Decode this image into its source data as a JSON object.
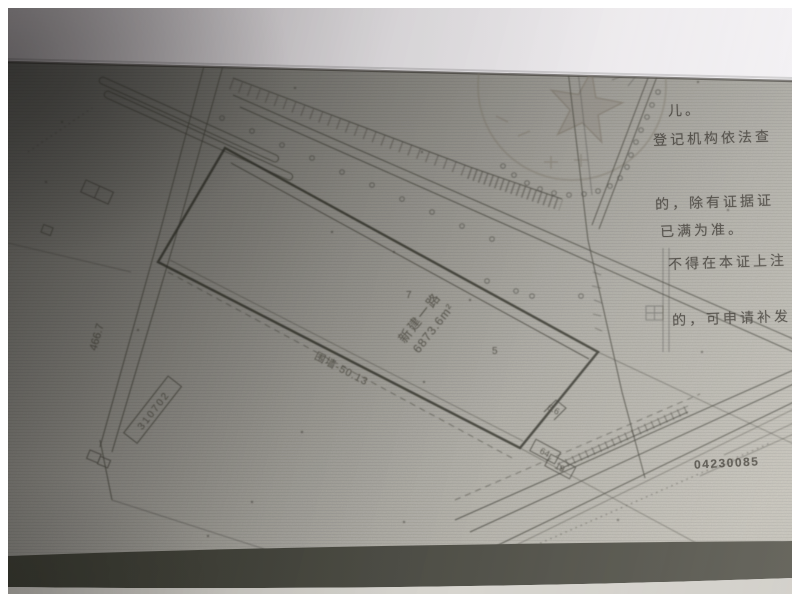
{
  "certificate": {
    "fragments": [
      "儿。",
      "登记机构依法查",
      "的，除有证据证",
      "已满为准。",
      "不得在本证上注",
      "的，可申请补发"
    ],
    "serial": "04230085"
  },
  "plan": {
    "parcel_name": "新建一路",
    "parcel_area": "6873.6m²",
    "dim_left": "466.7",
    "box_left": "310702",
    "wall_label": "围墙-50.13",
    "edge_dim": "6.6",
    "box_a": "64",
    "box_b": "19",
    "spot_a": "5",
    "spot_b": "7"
  },
  "colors": {
    "paper_dark": "#6a6964",
    "paper_light": "#c6c3ba",
    "surface_top": "#f0eef2",
    "shadow_band": "#46463c",
    "line_ink": "#45433c"
  }
}
